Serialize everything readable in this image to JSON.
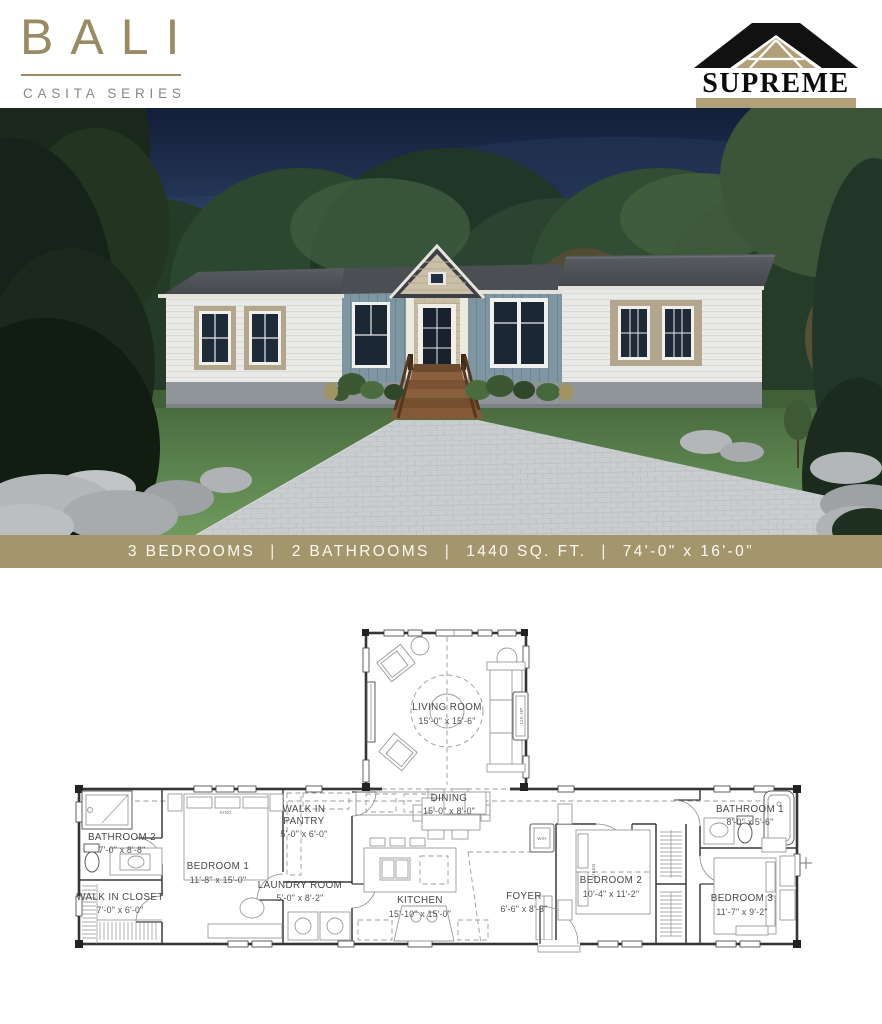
{
  "header": {
    "model_name": "BALI",
    "series_name": "CASITA SERIES",
    "brand_name": "SUPREME"
  },
  "spec_banner": {
    "separator": "|",
    "items": [
      "3 BEDROOMS",
      "2 BATHROOMS",
      "1440 SQ. FT.",
      "74'-0\" x 16'-0\""
    ]
  },
  "floor_plan": {
    "rooms": [
      {
        "id": "living-room",
        "name": "LIVING ROOM",
        "dims": "15'-0\" x 15'-6\""
      },
      {
        "id": "dining",
        "name": "DINING",
        "dims": "15'-0\" x 8'-0\""
      },
      {
        "id": "kitchen",
        "name": "KITCHEN",
        "dims": "15'-10\" x 15'-0\""
      },
      {
        "id": "foyer",
        "name": "FOYER",
        "dims": "6'-6\" x 8'-3\""
      },
      {
        "id": "laundry-room",
        "name": "LAUNDRY ROOM",
        "dims": "5'-0\" x 8'-2\""
      },
      {
        "id": "walk-in-pantry",
        "name_line1": "WALK IN",
        "name_line2": "PANTRY",
        "dims": "5'-0\" x 6'-0\""
      },
      {
        "id": "bedroom-1",
        "name": "BEDROOM 1",
        "dims": "11'-8\" x 15'-0\""
      },
      {
        "id": "bedroom-2",
        "name": "BEDROOM 2",
        "dims": "10'-4\" x 11'-2\""
      },
      {
        "id": "bedroom-3",
        "name": "BEDROOM 3",
        "dims": "11'-7\" x 9'-2\""
      },
      {
        "id": "bathroom-1",
        "name": "BATHROOM 1",
        "dims": "8'-0\" x 5'-6\""
      },
      {
        "id": "bathroom-2",
        "name": "BATHROOM 2",
        "dims": "7'-0\" x 8'-8\""
      },
      {
        "id": "walk-in-closet",
        "name": "WALK IN CLOSET",
        "dims": "7'-0\" x 6'-0\""
      }
    ],
    "annotations": {
      "bed1_size": "KING",
      "bed2_size": "QUEEN",
      "hvac_unit": "12K-HP",
      "water_heater": "W/H"
    }
  },
  "colors": {
    "accent_tan": "#9a8b65",
    "banner_bg": "#a4966c",
    "logo_tan": "#b2a078",
    "series_gray": "#85878a",
    "plan_line": "#353535",
    "house_siding_white": "#e9eae7",
    "house_siding_blue": "#7d96a1",
    "house_shake_tan": "#c8bda5",
    "roof_gray": "#4b4f54"
  }
}
